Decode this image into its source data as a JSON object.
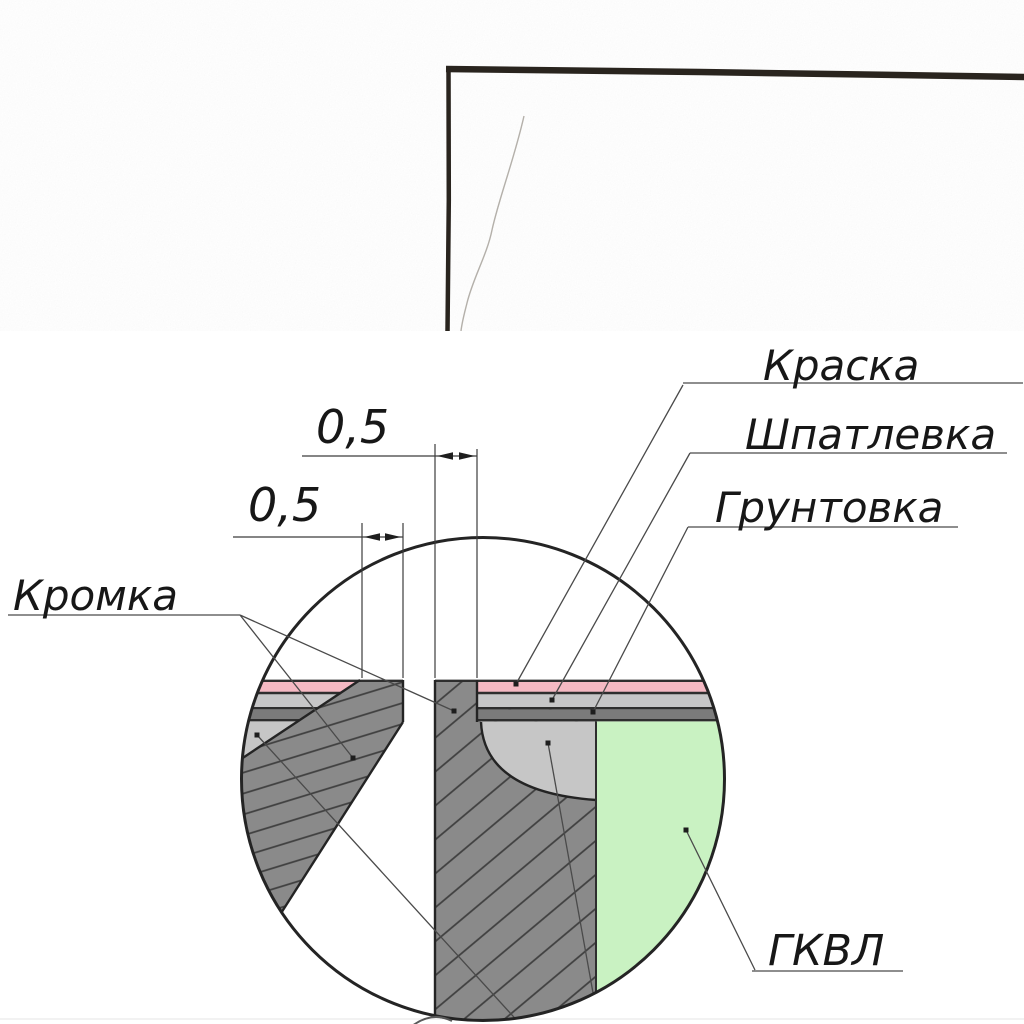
{
  "photo": {
    "wall_tone_top": "#746b60",
    "wall_tone_bottom": "#9b9386",
    "corner_line_color": "#29241e"
  },
  "detail": {
    "labels": {
      "paint": "Краска",
      "filler": "Шпатлевка",
      "primer": "Грунтовка",
      "edge": "Кромка",
      "board": "ГКВЛ"
    },
    "dimensions": {
      "top_gap": "0,5",
      "bottom_gap": "0,5"
    },
    "colors": {
      "paint": "#f5b9c3",
      "filler_band": "#c6c6c7",
      "primer_band": "#7b7b7b",
      "joint_filler": "#c6c6c6",
      "board_core": "#c9f2c2",
      "sheet": "#8a8a8a",
      "hatch": "#3f3f3f",
      "outline": "#242424"
    }
  }
}
